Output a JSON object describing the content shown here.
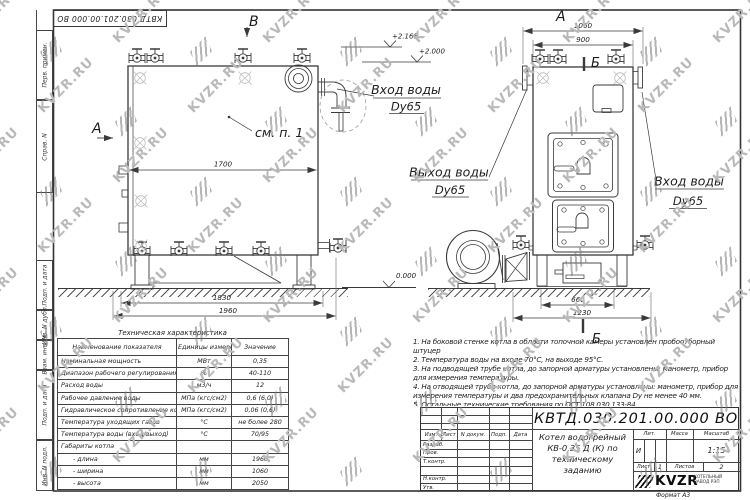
{
  "sheet": {
    "format_label": "Формат  А3",
    "watermark": {
      "text": "KVZR.RU",
      "color": "#b9b9b9"
    }
  },
  "doc": {
    "number": "КВТД.030.201.00.000  ВО",
    "name": [
      "Котел водогрейный",
      "КВ-0,35 Д (К) по",
      "техническому заданию"
    ],
    "header_cols": [
      "Изм.",
      "Лист",
      "N докум.",
      "Подп.",
      "Дата"
    ],
    "sig_rows": [
      "Разраб.",
      "Пров.",
      "Т.контр.",
      "",
      "Н.контр.",
      "Утв."
    ],
    "lit_label": "Лит.",
    "lit_value": "И",
    "mass_label": "Масса",
    "mass_value": "",
    "scale_label": "Масштаб",
    "scale_value": "1:15",
    "sheet_label": "Лист",
    "sheet_num": "1",
    "sheets_label": "Листов",
    "sheets_num": "2",
    "company": "KVZR",
    "company_line1": "КОТЕЛЬНЫЙ",
    "company_line2": "ЗАВОД РЭП"
  },
  "margin_labels": [
    "Перв. примен.",
    "Справ. N",
    "Подп. и дата",
    "Инв. N дубл.",
    "Взам. инв. N",
    "Подп. и дата",
    "Инв. N подл."
  ],
  "views": {
    "letter_a": "А",
    "letter_b": "В",
    "letter_sec": "Б",
    "see_note": "см. п. 1",
    "inlet_line1": "Вход воды",
    "inlet_line2": "Dy65",
    "outlet_line1": "Выход воды",
    "outlet_line2": "Dy65",
    "elev_top": "+2.165",
    "elev_mid": "+2.000",
    "elev_zero": "0.000",
    "dims": {
      "front_width": "1700",
      "front_base": "1830",
      "front_total": "1960",
      "side_total": "1060",
      "side_body": "900",
      "side_legs": "660",
      "side_base": "1230"
    }
  },
  "tech_table": {
    "title": "Техническая характеристика",
    "headers": [
      "Наименование показателя",
      "Единицы измерения",
      "Значение"
    ],
    "rows": [
      [
        "Номинальная мощность",
        "МВт",
        "0,35"
      ],
      [
        "Диапазон рабочего регулирования",
        "%",
        "40-110"
      ],
      [
        "Расход воды",
        "м3/ч",
        "12"
      ],
      [
        "Рабочее давление воды",
        "МПа (кгс/см2)",
        "0,6 (6,0)"
      ],
      [
        "Гидравлическое сопротивление котла",
        "МПа (кгс/см2)",
        "0,06 (0,6)"
      ],
      [
        "Температура уходящих газов",
        "°С",
        "не более 280"
      ],
      [
        "Температура воды (вход/выход)",
        "°С",
        "70/95"
      ],
      [
        "Габариты котла",
        "",
        ""
      ],
      [
        "- длина",
        "мм",
        "1960"
      ],
      [
        "- ширина",
        "мм",
        "1060"
      ],
      [
        "- высота",
        "мм",
        "2050"
      ]
    ]
  },
  "notes": [
    "1. На боковой стенке котла в области топочной камеры установлен пробоотборный штуцер",
    "2. Температура воды на входе 70°С, на выходе 95°С.",
    "3. На подводящей трубе котла, до запорной арматуры установлены: манометр, прибор для измерения температуры.",
    "4. На отводящей трубе котла, до запорной арматуры установлены: манометр, прибор для измерения температуры и два предохранительных клапана Dу не менее 40 мм.",
    "5. Остальные технические требования по ОСТ 108.030.133-84."
  ]
}
